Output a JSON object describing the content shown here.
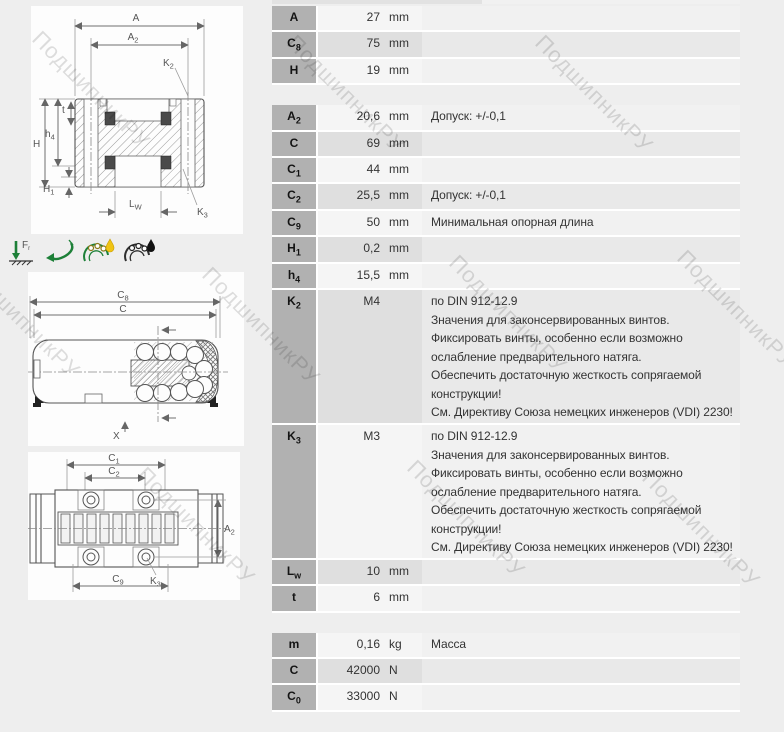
{
  "page": {
    "background": "#eeeeee",
    "panel_background": "#fdfdfd"
  },
  "watermark": {
    "text": "ПодшипникРУ",
    "color": "#d5d5d5"
  },
  "colors": {
    "icon_green": "#1d8038",
    "oil_drop": "#f0c414",
    "grease_drop": "#111111",
    "label_cell": "#b1b1b1"
  },
  "icons": {
    "radial_load": {
      "label_main": "F",
      "label_sub": "r"
    }
  },
  "drawings": {
    "cross_section": {
      "dims": {
        "A": {
          "main": "A",
          "sub": ""
        },
        "A2": {
          "main": "A",
          "sub": "2"
        },
        "K2": {
          "main": "K",
          "sub": "2"
        },
        "t": {
          "main": "t",
          "sub": ""
        },
        "h4": {
          "main": "h",
          "sub": "4"
        },
        "H": {
          "main": "H",
          "sub": ""
        },
        "H1": {
          "main": "H",
          "sub": "1"
        },
        "LW": {
          "main": "L",
          "sub": "W"
        },
        "K3": {
          "main": "K",
          "sub": "3"
        }
      }
    },
    "side_view": {
      "dims": {
        "C8": {
          "main": "C",
          "sub": "8"
        },
        "C": {
          "main": "C",
          "sub": ""
        },
        "X": {
          "main": "X",
          "sub": ""
        }
      }
    },
    "top_view": {
      "dims": {
        "C1": {
          "main": "C",
          "sub": "1"
        },
        "C2": {
          "main": "C",
          "sub": "2"
        },
        "A2": {
          "main": "A",
          "sub": "2"
        },
        "K3": {
          "main": "K",
          "sub": "3"
        },
        "C9": {
          "main": "C",
          "sub": "9"
        }
      }
    }
  },
  "table": {
    "groups": [
      {
        "rows": [
          {
            "label": "A",
            "sub": "",
            "value": "27",
            "unit": "mm",
            "note": ""
          },
          {
            "label": "C",
            "sub": "8",
            "value": "75",
            "unit": "mm",
            "note": ""
          },
          {
            "label": "H",
            "sub": "",
            "value": "19",
            "unit": "mm",
            "note": ""
          }
        ]
      },
      {
        "rows": [
          {
            "label": "A",
            "sub": "2",
            "value": "20,6",
            "unit": "mm",
            "note": "Допуск: +/-0,1"
          },
          {
            "label": "C",
            "sub": "",
            "value": "69",
            "unit": "mm",
            "note": ""
          },
          {
            "label": "C",
            "sub": "1",
            "value": "44",
            "unit": "mm",
            "note": ""
          },
          {
            "label": "C",
            "sub": "2",
            "value": "25,5",
            "unit": "mm",
            "note": "Допуск: +/-0,1"
          },
          {
            "label": "C",
            "sub": "9",
            "value": "50",
            "unit": "mm",
            "note": "Минимальная опорная длина"
          },
          {
            "label": "H",
            "sub": "1",
            "value": "0,2",
            "unit": "mm",
            "note": ""
          },
          {
            "label": "h",
            "sub": "4",
            "value": "15,5",
            "unit": "mm",
            "note": ""
          },
          {
            "label": "K",
            "sub": "2",
            "value": "M4",
            "unit": "",
            "note": "по DIN 912-12.9\nЗначения для законсервированных винтов.\nФиксировать винты, особенно если возможно\nослабление предварительного натяга.\nОбеспечить достаточную жесткость сопрягаемой\nконструкции!\nСм. Директиву Союза немецких инженеров (VDI) 2230!"
          },
          {
            "label": "K",
            "sub": "3",
            "value": "M3",
            "unit": "",
            "note": "по DIN 912-12.9\nЗначения для законсервированных винтов.\nФиксировать винты, особенно если возможно\nослабление предварительного натяга.\nОбеспечить достаточную жесткость сопрягаемой\nконструкции!\nСм. Директиву Союза немецких инженеров (VDI) 2230!"
          },
          {
            "label": "L",
            "sub": "w",
            "value": "10",
            "unit": "mm",
            "note": ""
          },
          {
            "label": "t",
            "sub": "",
            "value": "6",
            "unit": "mm",
            "note": ""
          }
        ]
      },
      {
        "rows": [
          {
            "label": "m",
            "sub": "",
            "value": "0,16",
            "unit": "kg",
            "note": "Масса"
          },
          {
            "label": "C",
            "sub": "",
            "value": "42000",
            "unit": "N",
            "note": ""
          },
          {
            "label": "C",
            "sub": "0",
            "value": "33000",
            "unit": "N",
            "note": ""
          }
        ]
      }
    ]
  }
}
